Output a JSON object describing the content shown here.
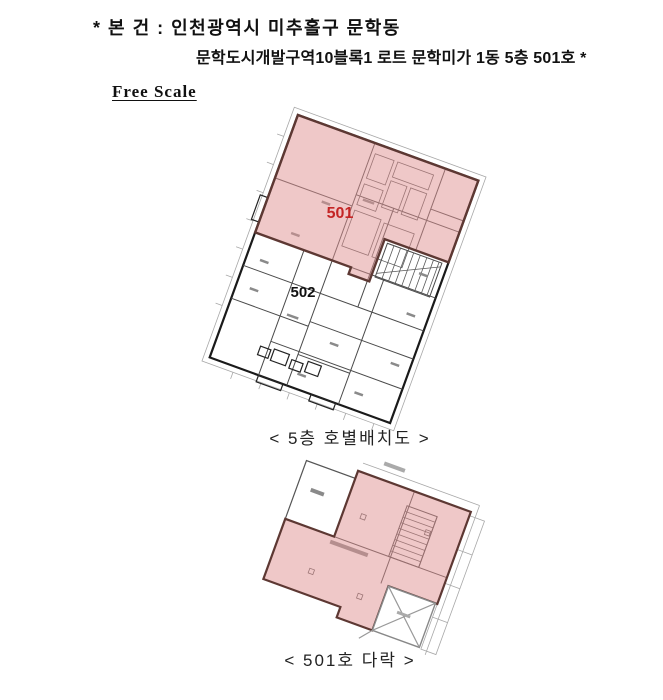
{
  "header": {
    "line1": "* 본 건 : 인천광역시 미추홀구 문학동",
    "line2": "문학도시개발구역10블록1 로트 문학미가 1동 5층 501호 *",
    "scale_label": "Free Scale"
  },
  "floor5": {
    "caption": "< 5층 호별배치도 >",
    "highlighted_unit": "501",
    "other_unit": "502"
  },
  "attic": {
    "caption": "< 501호 다락 >"
  },
  "colors": {
    "highlight_fill": "#f0c2c2",
    "highlight_border": "#5d3833",
    "unit_501_label": "#c42525",
    "unit_502_label": "#111111",
    "wall_line": "#1a1a1a"
  }
}
